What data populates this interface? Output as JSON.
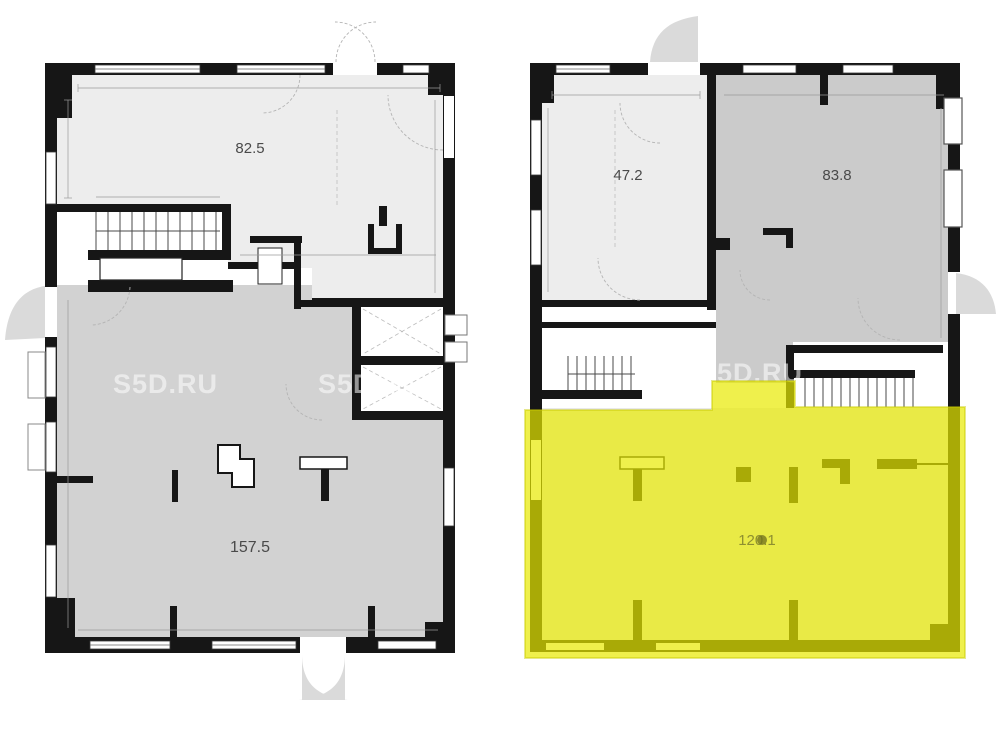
{
  "title": "two-storey commercial floor plans with highlighted unit",
  "watermark": {
    "text": "S5D.RU"
  },
  "rooms": {
    "left_upper": {
      "label": "82.5"
    },
    "left_lower": {
      "label": "157.5"
    },
    "right_upper_left": {
      "label": "47.2"
    },
    "right_upper_right": {
      "label": "83.8"
    },
    "right_lower_highlight": {
      "label": "120.1",
      "highlighted": true
    }
  },
  "colors": {
    "wall": "#161616",
    "room_light": "#ededed",
    "room_mid": "#d2d2d2",
    "room_dark": "#cbcbcb",
    "highlight_yellow": "#e4e44c",
    "highlight_wall_olive": "#9a9a28",
    "label_gray": "#4a4a4a",
    "watermark_white": "#ffffff"
  }
}
